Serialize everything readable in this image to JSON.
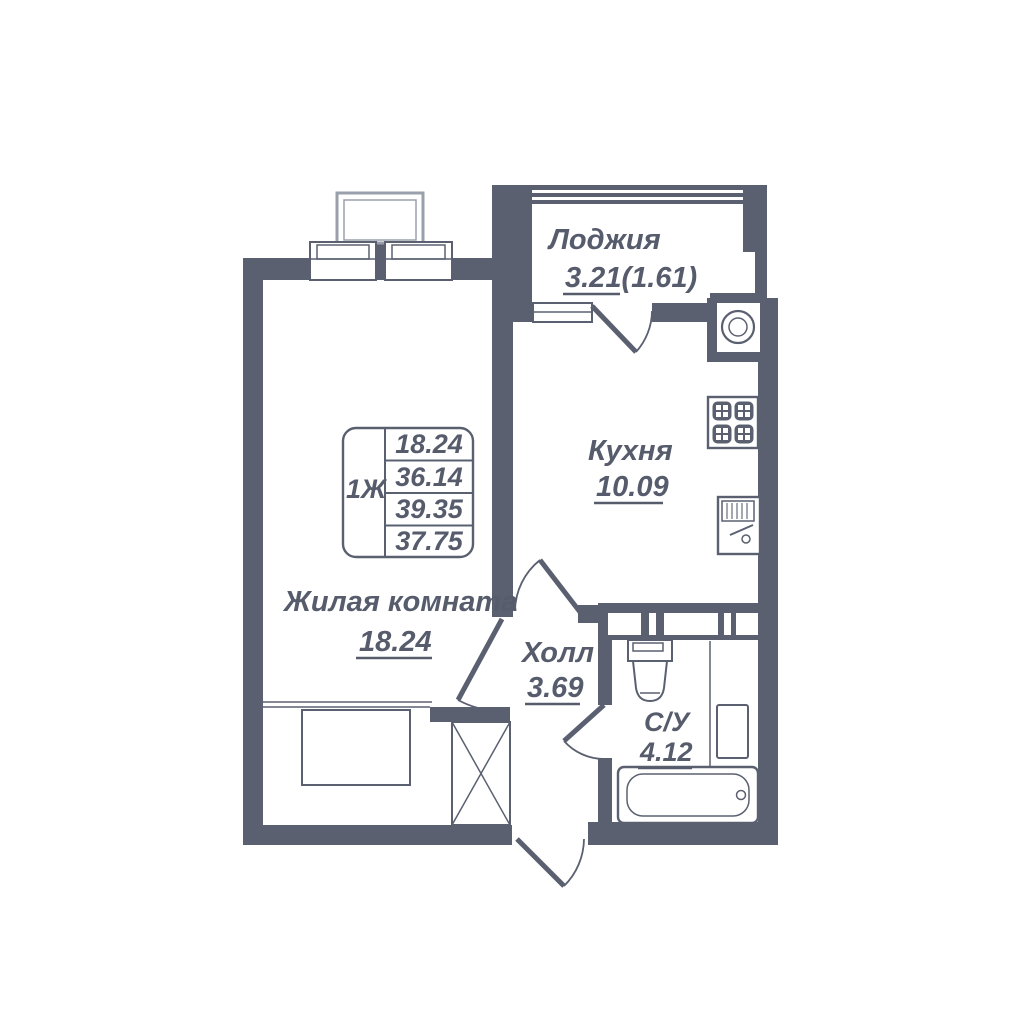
{
  "plan": {
    "rooms": {
      "living": {
        "name": "Жилая комната",
        "area": "18.24"
      },
      "kitchen": {
        "name": "Кухня",
        "area": "10.09"
      },
      "loggia": {
        "name": "Лоджия",
        "area": "3.21",
        "area_reduced": "(1.61)"
      },
      "hall": {
        "name": "Холл",
        "area": "3.69"
      },
      "bathroom": {
        "name": "С/У",
        "area": "4.12"
      }
    },
    "stamp": {
      "apartment_type": "1Ж",
      "values": [
        "18.24",
        "36.14",
        "39.35",
        "37.75"
      ]
    },
    "colors": {
      "wall": "#5a6070",
      "text": "#565c6c",
      "light_outline": "#9aa0ab",
      "background": "#ffffff"
    }
  }
}
